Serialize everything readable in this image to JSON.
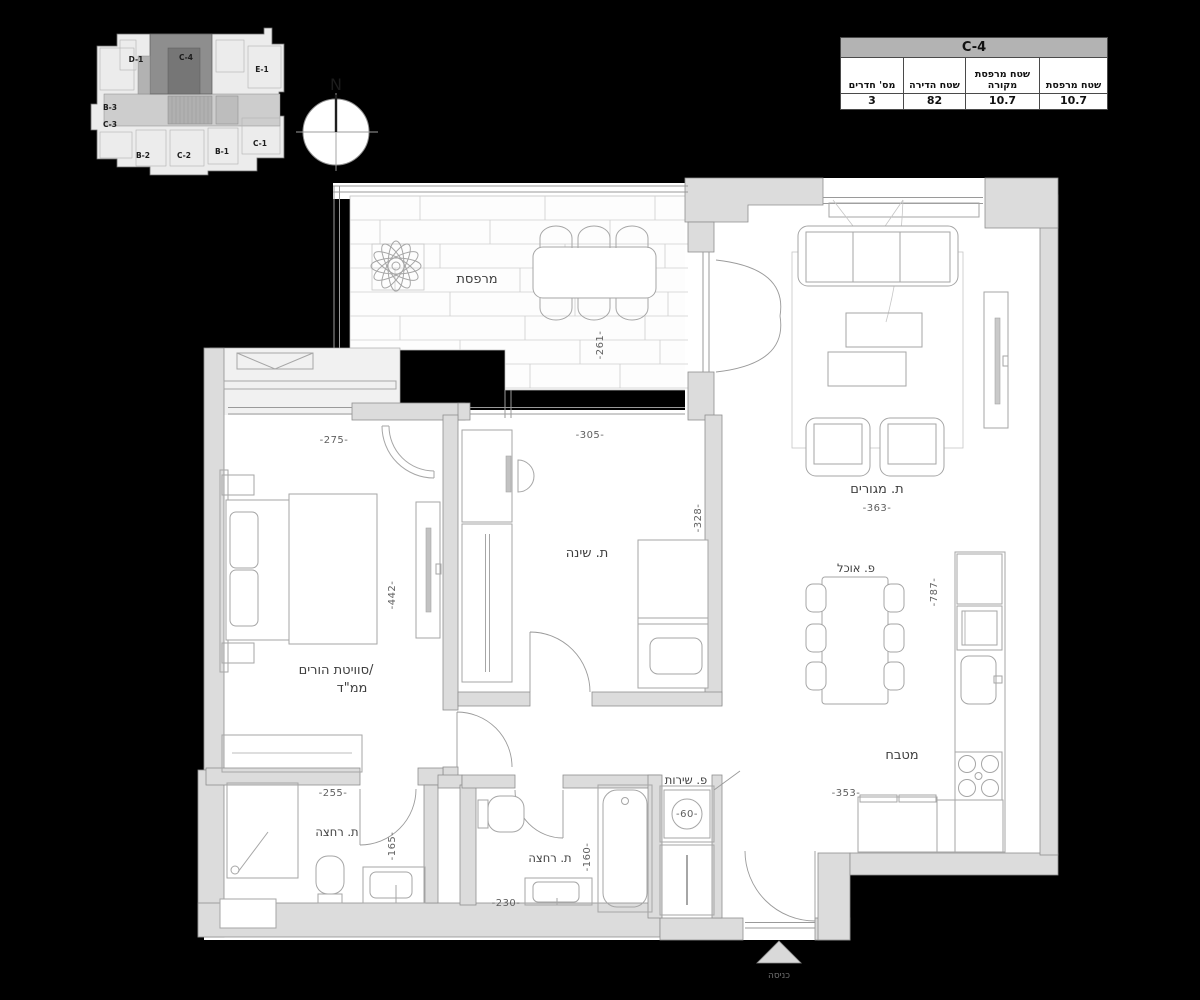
{
  "key_plan": {
    "units": [
      "D-1",
      "C-4",
      "E-1",
      "B-3",
      "C-3",
      "B-2",
      "C-2",
      "B-1",
      "C-1"
    ],
    "highlighted_unit": "C-4"
  },
  "compass": {
    "north_label": "N"
  },
  "info_table": {
    "title": "C-4",
    "columns": [
      {
        "label": "מס' חדרים",
        "value": "3"
      },
      {
        "label": "שטח הדירה",
        "value": "82"
      },
      {
        "label": "שטח מרפסת מקורה",
        "value": "10.7"
      },
      {
        "label": "שטח מרפסת",
        "value": "10.7"
      }
    ]
  },
  "floor_plan": {
    "rooms": {
      "balcony": {
        "label": "מרפסת",
        "depth_dim": "-261-"
      },
      "living": {
        "label": "ת. מגורים",
        "width_dim": "-363-"
      },
      "dining": {
        "label": "פ. אוכל"
      },
      "kitchen": {
        "label": "מטבח",
        "height_dim": "-787-",
        "width_dim": "-353-"
      },
      "master_suite": {
        "label_line1": "סוויטת הורים/",
        "label_line2": "ממ\"ד",
        "width_dim": "-275-",
        "height_dim": "-442-"
      },
      "bedroom": {
        "label": "ת. שינה",
        "width_dim": "-305-",
        "height_dim": "-328-"
      },
      "bathroom_1": {
        "label": "ת. רחצה",
        "width_dim": "-255-",
        "height_dim": "-165-"
      },
      "bathroom_2": {
        "label": "ת. רחצה",
        "width_dim": "-230-",
        "height_dim": "-160-"
      },
      "service": {
        "label": "פ. שירות",
        "washer_dim": "-60-"
      },
      "entrance": {
        "label": "כניסה"
      }
    }
  }
}
